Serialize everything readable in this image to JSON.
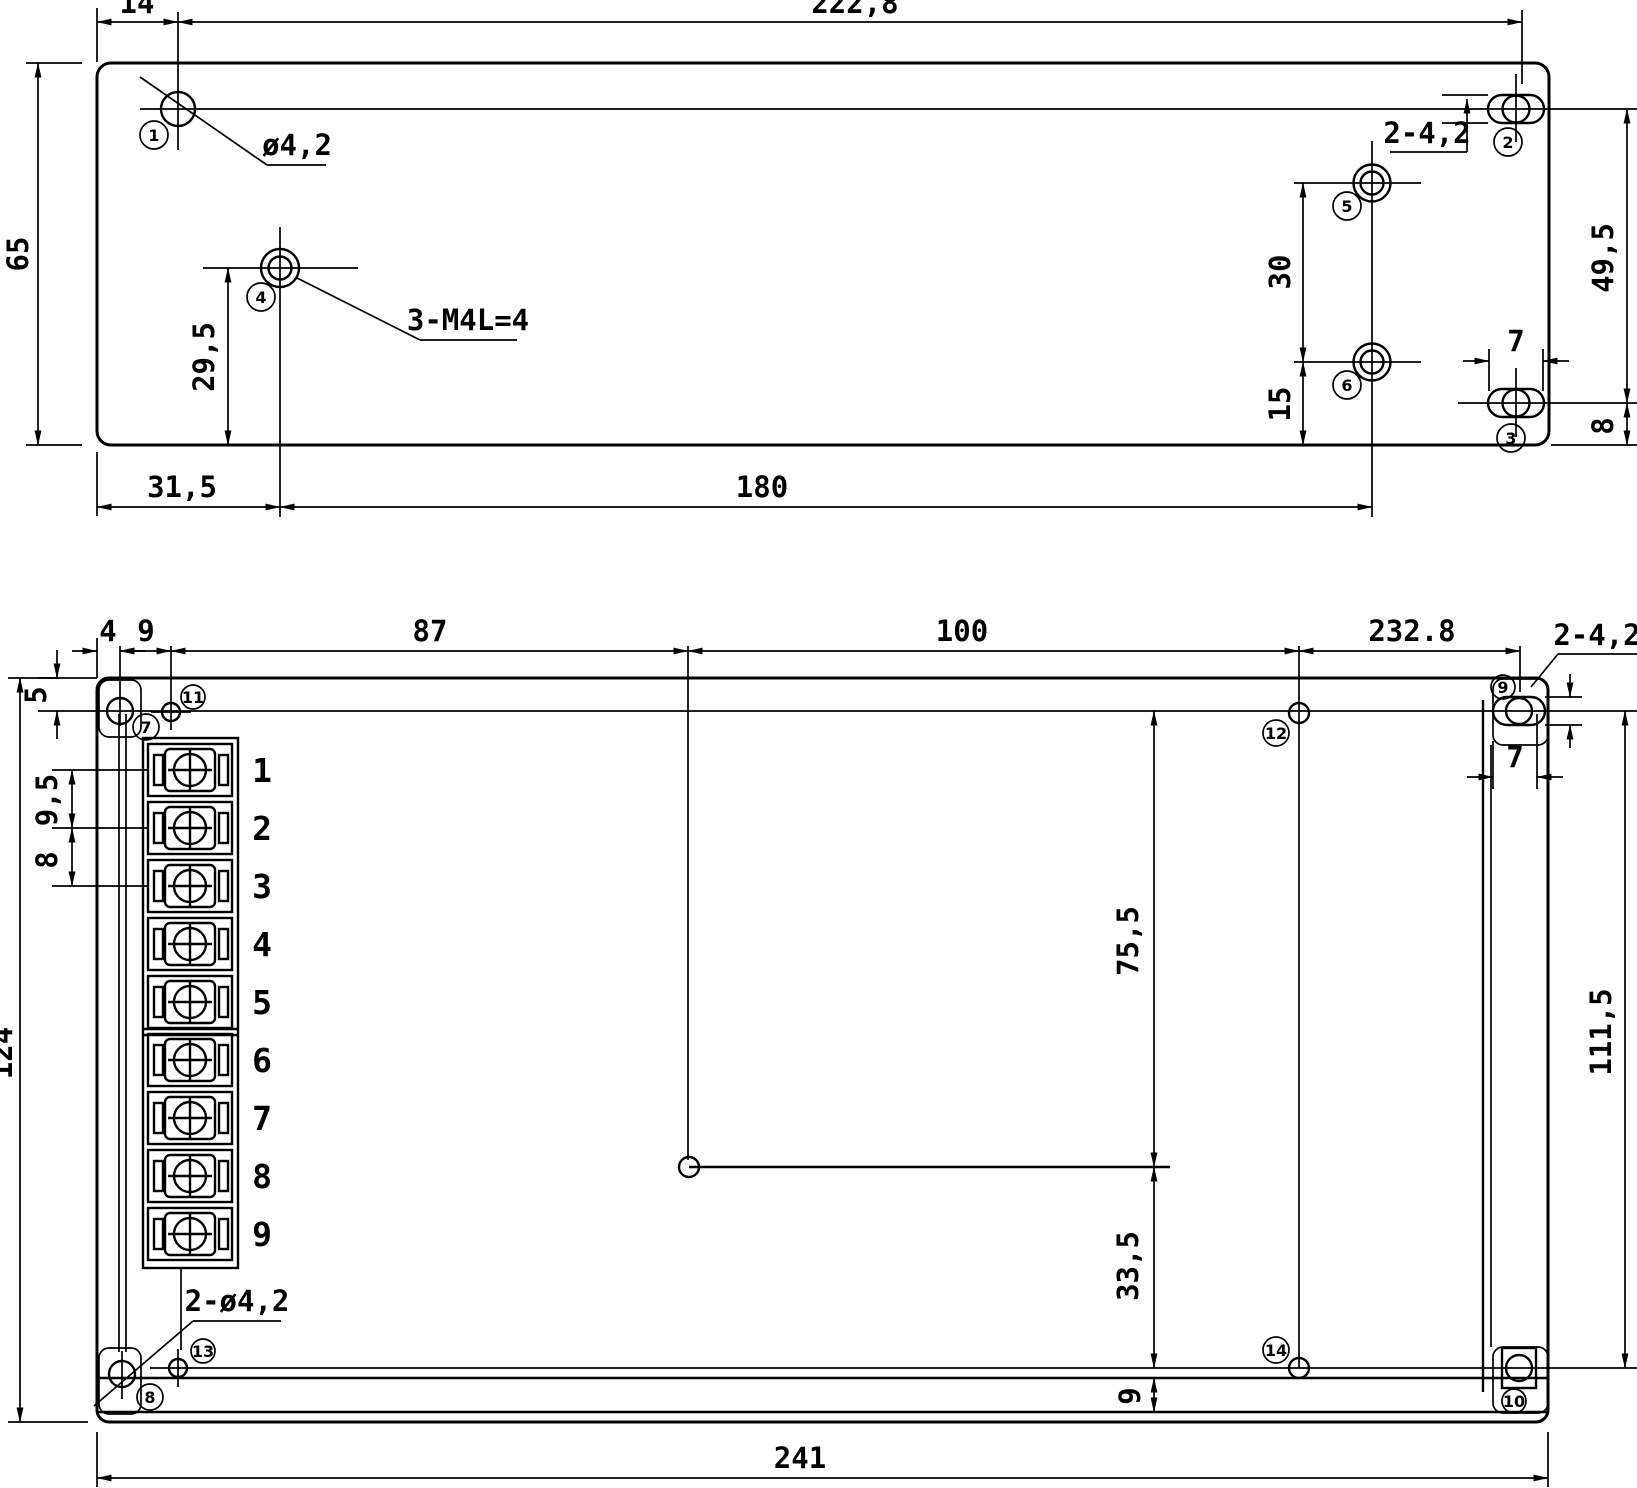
{
  "drawing": {
    "background": "#ffffff",
    "line_color": "#000000",
    "description": "Two-view dimensional drawing of enclosure mounting holes with terminal block"
  },
  "top_view": {
    "dims": {
      "w14": "14",
      "w222_8": "222,8",
      "h65": "65",
      "h29_5": "29,5",
      "w31_5": "31,5",
      "w180": "180",
      "h30": "30",
      "h15": "15",
      "h49_5": "49,5",
      "w7": "7",
      "h8": "8"
    },
    "notes": {
      "hole_dia": "ø4,2",
      "tapped": "3-M4L=4",
      "slots": "2-4,2"
    },
    "callouts": {
      "c1": "1",
      "c2": "2",
      "c3": "3",
      "c4": "4",
      "c5": "5",
      "c6": "6"
    }
  },
  "bottom_view": {
    "dims": {
      "w4": "4",
      "w9": "9",
      "w87": "87",
      "w100": "100",
      "w232_8": "232.8",
      "w241": "241",
      "h5": "5",
      "h124": "124",
      "h111_5": "111,5",
      "h75_5": "75,5",
      "h33_5": "33,5",
      "h9": "9",
      "w7": "7",
      "p9_5": "9,5",
      "p8": "8"
    },
    "notes": {
      "slots": "2-4,2",
      "holes": "2-ø4,2"
    },
    "callouts": {
      "c7": "7",
      "c8": "8",
      "c9": "9",
      "c10": "10",
      "c11": "11",
      "c12": "12",
      "c13": "13",
      "c14": "14"
    },
    "terminals": [
      "1",
      "2",
      "3",
      "4",
      "5",
      "6",
      "7",
      "8",
      "9"
    ]
  }
}
